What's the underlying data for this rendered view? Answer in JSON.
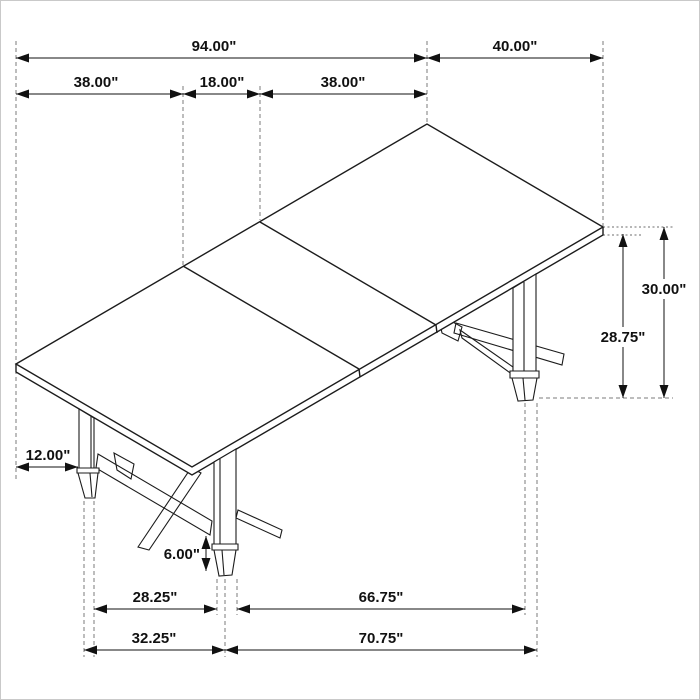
{
  "drawing": {
    "kind": "isometric furniture dimension diagram",
    "subject": "extension dining table with trestle legs"
  },
  "dim_labels": {
    "overall_length": "94.00\"",
    "right_end_width": "40.00\"",
    "left_leaf": "38.00\"",
    "center_leaf": "18.00\"",
    "right_leaf": "38.00\"",
    "height_total": "30.00\"",
    "height_underside": "28.75\"",
    "overhang": "12.00\"",
    "foot_height": "6.00\"",
    "feet_span_width_inner": "28.25\"",
    "feet_span_length_inner": "66.75\"",
    "feet_span_width_outer": "32.25\"",
    "feet_span_length_outer": "70.75\""
  }
}
